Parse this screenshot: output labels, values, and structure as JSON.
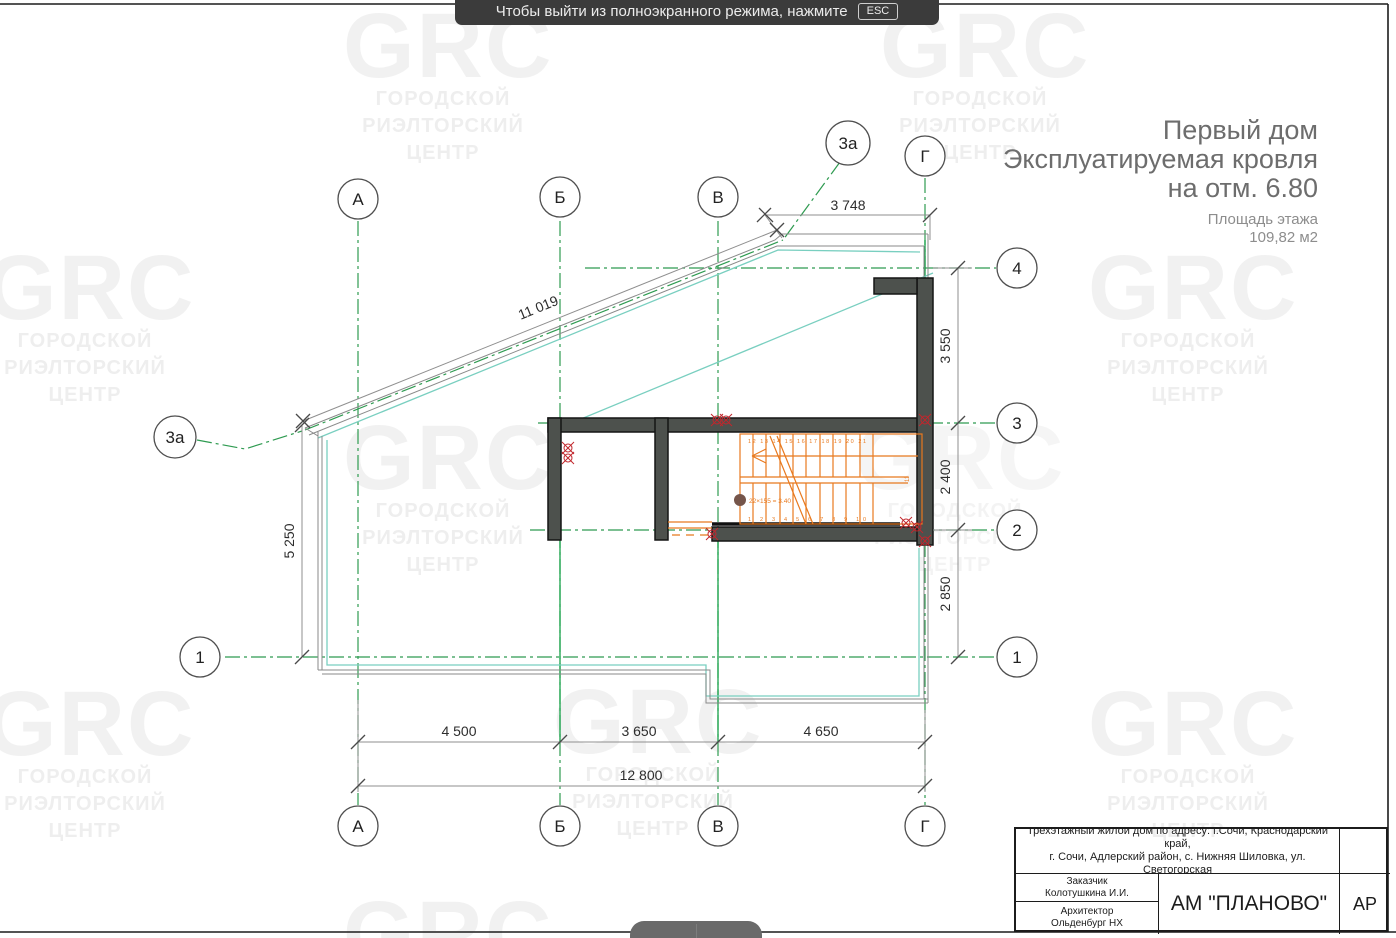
{
  "banner": {
    "text": "Чтобы выйти из полноэкранного режима, нажмите",
    "key": "ESC"
  },
  "header": {
    "line1": "Первый дом",
    "line2": "Эксплуатируемая кровля",
    "line3": "на отм. 6.80",
    "area_label": "Площадь этажа",
    "area_value": "109,82 м2"
  },
  "watermark": {
    "logo": "GRC",
    "line1": "ГОРОДСКОЙ",
    "line2": "РИЭЛТОРСКИЙ",
    "line3": "ЦЕНТР"
  },
  "axis": {
    "A": "А",
    "B": "Б",
    "V": "В",
    "G": "Г",
    "n1": "1",
    "n2": "2",
    "n3": "3",
    "n4": "4",
    "n3a": "3а"
  },
  "dims": {
    "top": "3 748",
    "roof": "11 019",
    "right1": "3 550",
    "right2": "2 400",
    "right3": "2 850",
    "left": "5 250",
    "bottom1": "4 500",
    "bottom2": "3 650",
    "bottom3": "4 650",
    "total": "12 800"
  },
  "stair": {
    "note": "22×155 = 3.40",
    "top_numbers": "12 13 14 15 16 17 18 19 20 21",
    "bottom_numbers": "1 2 3 4 5 6 7 8 9 10",
    "landing_number": "11"
  },
  "titleblock": {
    "address1": "Трехэтажный жилой дом по адресу: г.Сочи, Краснодарский край,",
    "address2": "г. Сочи, Адлерский район, с. Нижняя Шиловка, ул. Светогорская",
    "customer_label": "Заказчик",
    "customer_name": "Колотушкина И.И.",
    "architect_label": "Архитектор",
    "architect_name": "Ольденбург НХ",
    "firm": "АМ \"ПЛАНОВО\"",
    "code": "АР"
  },
  "colors": {
    "grid_green": "#2f9b51",
    "roof_teal": "#79cfc0",
    "stair_orange": "#e8791e",
    "wall_fill": "#4d514d",
    "drain_red": "#c1272d"
  }
}
